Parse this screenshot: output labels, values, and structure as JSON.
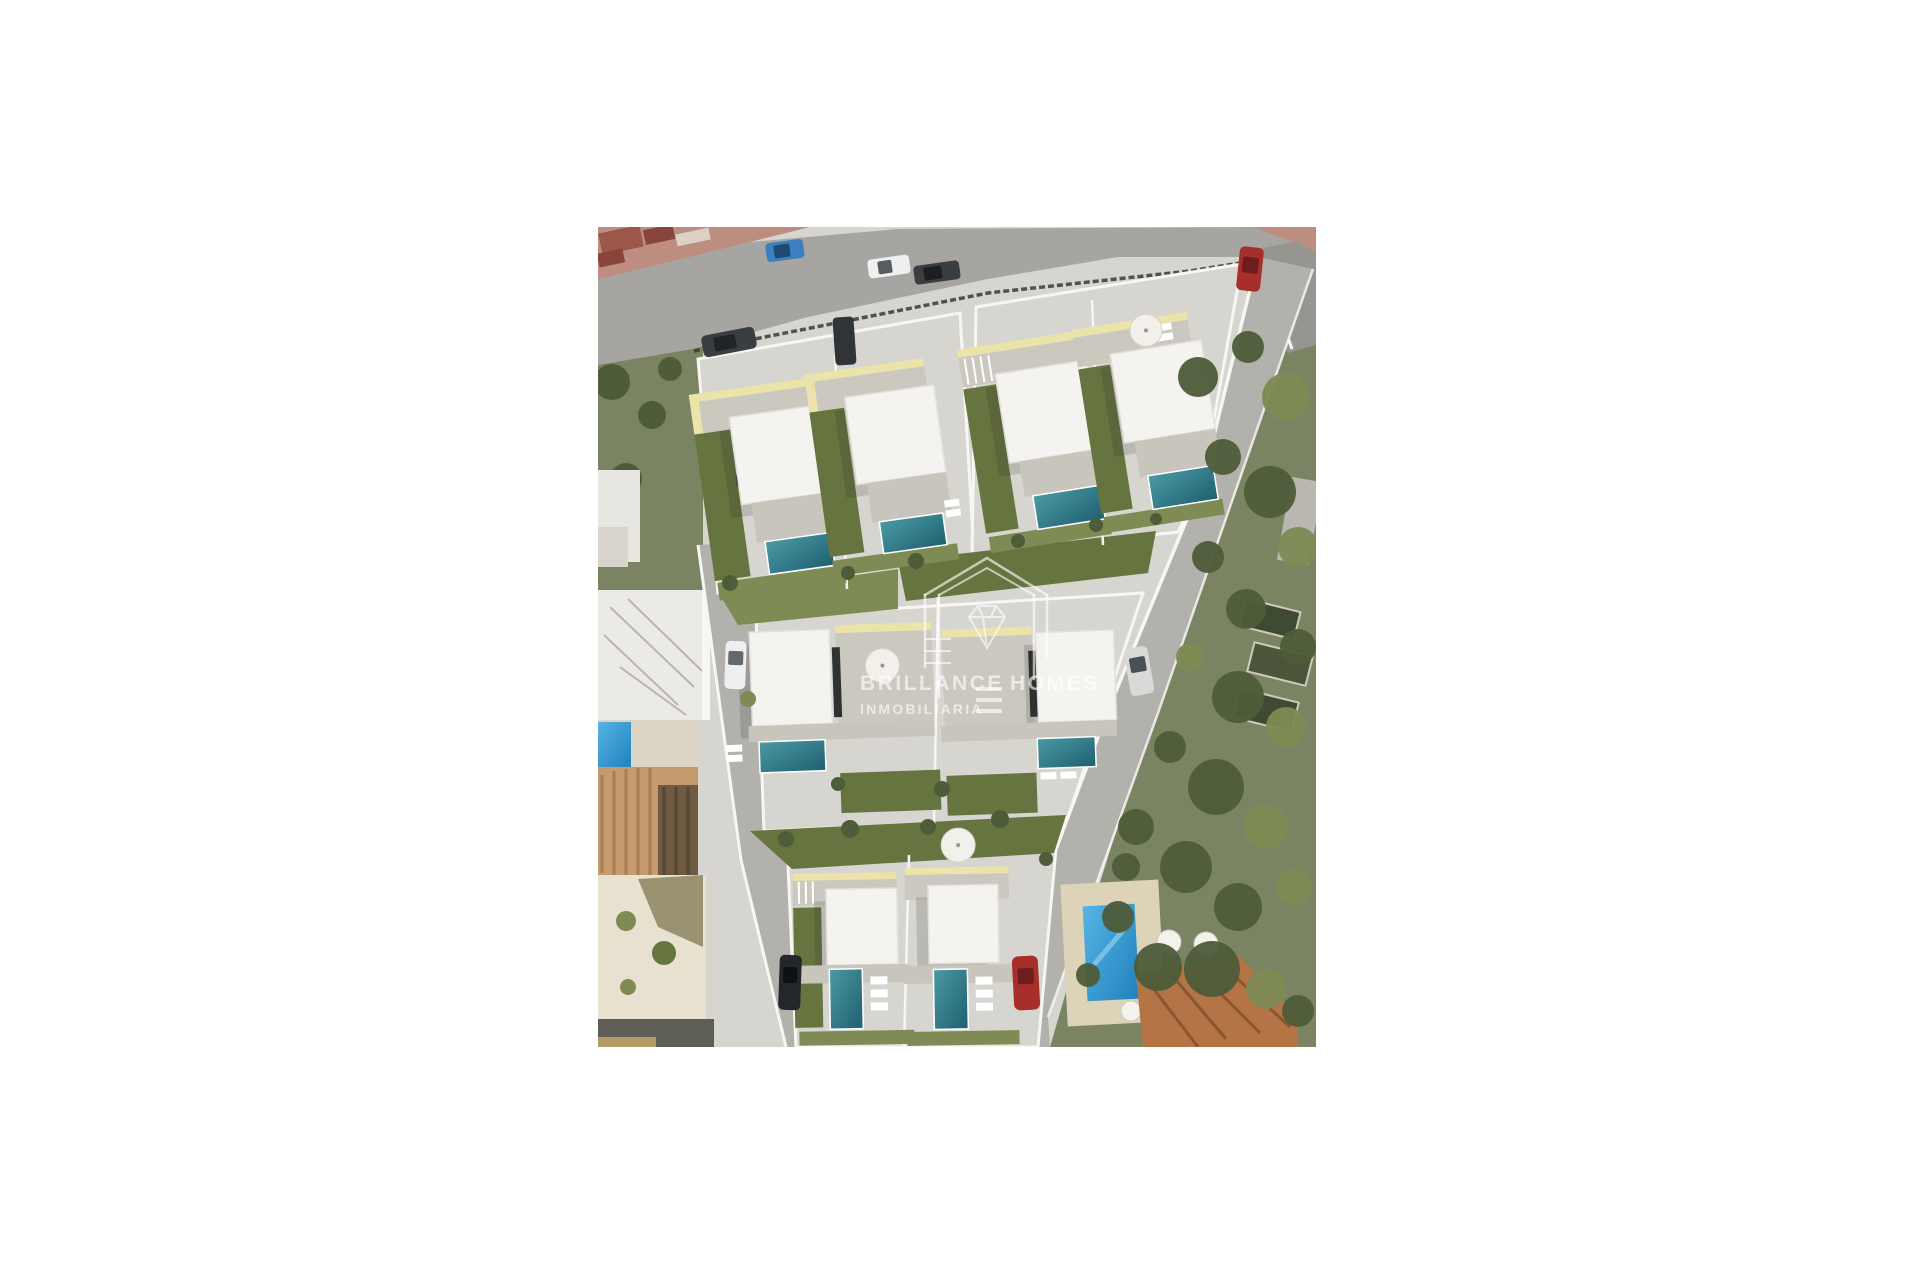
{
  "scene": {
    "alt": "Aerial top-down 3D render of a new residential development with eight white modern villas with private teal pools and lawns, a road with parked cars along the top, existing houses with tiled roofs on the left, and a green tree belt with an existing villa and blue pool on the right",
    "type": "architectural aerial render"
  },
  "watermark": {
    "brand_first": "BRILLANCE",
    "brand_second": "HOMES",
    "subtitle": "INMOBILIARIA"
  },
  "palette": {
    "page_bg": "#ffffff",
    "paving_light": "#d7d5cf",
    "paving_mid": "#c8c5bd",
    "asphalt": "#a6a5a1",
    "asphalt_dark": "#97958f",
    "sidewalk_red": "#bd8e80",
    "roof_red": "#9c564a",
    "roof_red_dark": "#87453c",
    "villa_roof": "#f4f3ef",
    "roof_edge": "#e2e0da",
    "parapet_cream": "#ece3aa",
    "terrace_gray": "#cbc8c0",
    "wall_white": "#f7f6f2",
    "pool_teal_a": "#4a9aa6",
    "pool_teal_b": "#1f5f6e",
    "pool_blue_a": "#55b5e3",
    "pool_blue_b": "#2180be",
    "lawn": "#66743f",
    "lawn_light": "#7e8b54",
    "tree_dark": "#4e5c3a",
    "olive": "#7b8462",
    "tan_roof": "#c49a6e",
    "tan_roof_dark": "#6f5b44",
    "terra_roof": "#b57446",
    "terra_ridge": "#8a5632",
    "courtyard": "#e9e1d0",
    "dark_band": "#5e5e57",
    "tan_strip": "#b49a66",
    "fence_dark": "#3b3a36",
    "furniture_dark": "#46423a",
    "shadow": "rgba(40,40,35,0.16)",
    "watermark": "rgba(255,255,255,0.62)",
    "car_blue": "#3c80bf",
    "car_white": "#eef0f0",
    "car_dark": "#3a3e40",
    "car_red": "#a62f2c",
    "car_black": "#23262a",
    "car_silver": "#d9d9d7",
    "glass_dark": "#2f3330"
  }
}
